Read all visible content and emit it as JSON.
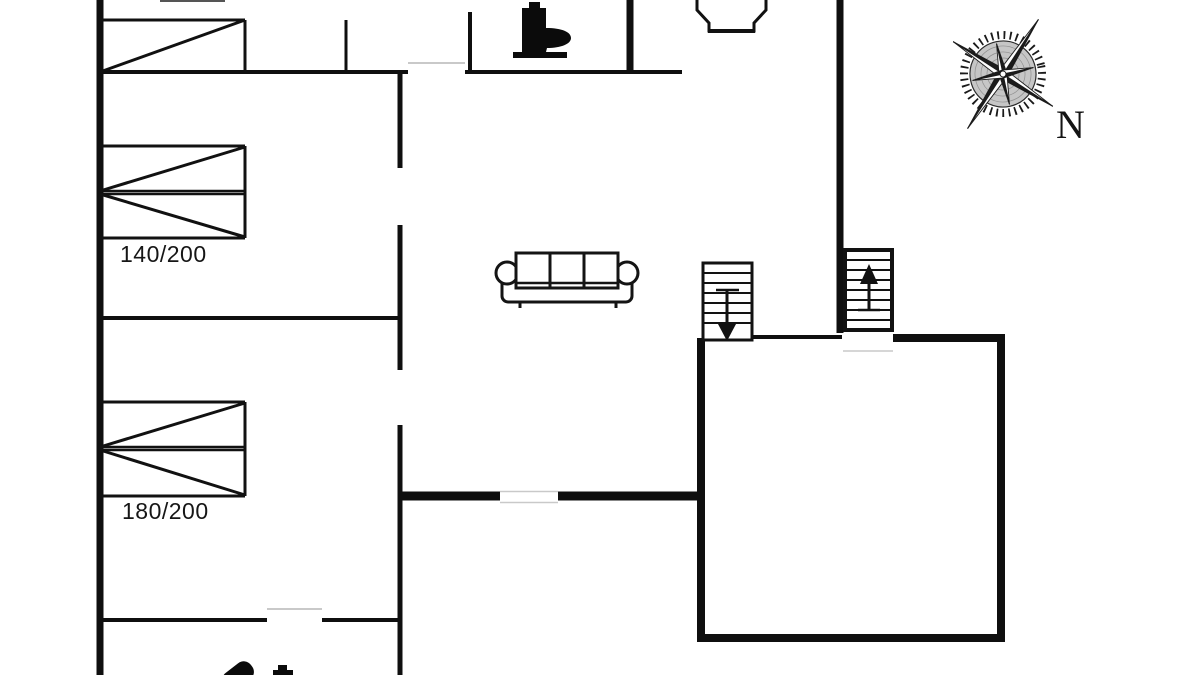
{
  "floorplan": {
    "type": "house-floor-plan",
    "background_color": "#ffffff",
    "line_color": "#0f0f0f",
    "door_marker_color": "#c9c9c9",
    "beds": {
      "double_140": {
        "label": "140/200"
      },
      "double_180": {
        "label": "180/200"
      }
    },
    "compass": {
      "north_label": "N"
    },
    "icons": [
      "single-bed-icon",
      "double-bed-140-icon",
      "double-bed-180-icon",
      "toilet-icon",
      "sofa-icon",
      "stairs-down-icon",
      "stairs-up-icon",
      "fireplace-icon",
      "compass-rose-icon",
      "shower-head-icon",
      "tap-icon"
    ]
  }
}
